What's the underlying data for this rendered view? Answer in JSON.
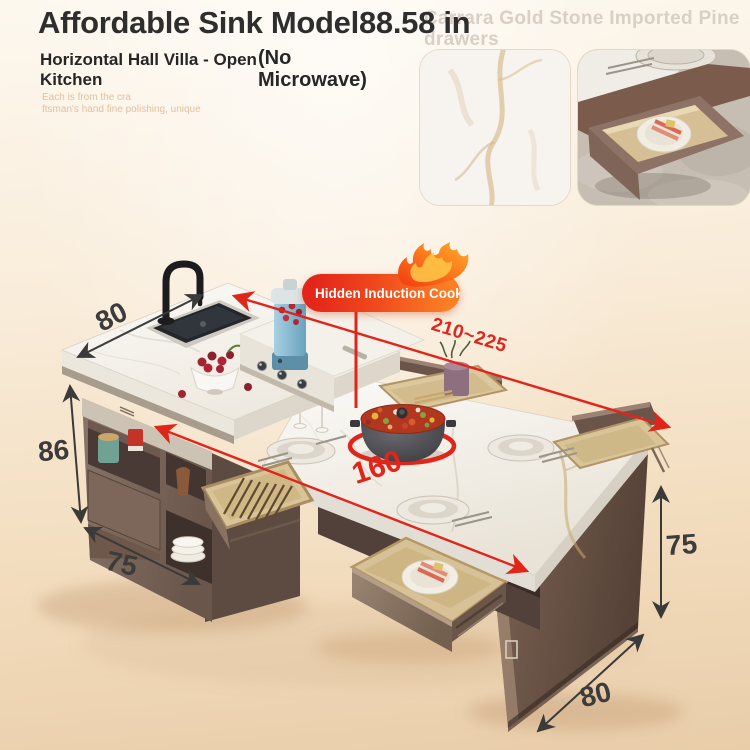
{
  "header": {
    "title": "Affordable Sink Model88.58 in",
    "subtitle_line1": "Horizontal Hall Villa - Open",
    "subtitle_line2": "Kitchen",
    "note_line1": "(No",
    "note_line2": "Microwave)",
    "tagline_line1": "Each is from the cra",
    "tagline_line2": "ftsman's hand fine polishing, unique",
    "watermark_line1": "Carrara Gold Stone Imported Pine",
    "watermark_line2": "drawers"
  },
  "badge": {
    "label": "Hidden Induction Cooktop"
  },
  "dimensions": {
    "counter_depth": "80",
    "counter_height": "86",
    "cabinet_width": "75",
    "total_length": "210~225",
    "table_length": "160",
    "table_height": "75",
    "table_depth": "80"
  },
  "colors": {
    "accent_red": "#e0251b",
    "flame_orange": "#fb7f25",
    "dimension_dark": "#3c3c3c",
    "cabinet_brown": "#7a6254",
    "marble_white": "#f7f4ee",
    "tray_wood": "#d8c297",
    "watermark_gray": "#d9d0c5",
    "text_dark": "#2e2e2e",
    "background_top": "#fdf8ef",
    "background_bottom": "#e9cda9"
  }
}
